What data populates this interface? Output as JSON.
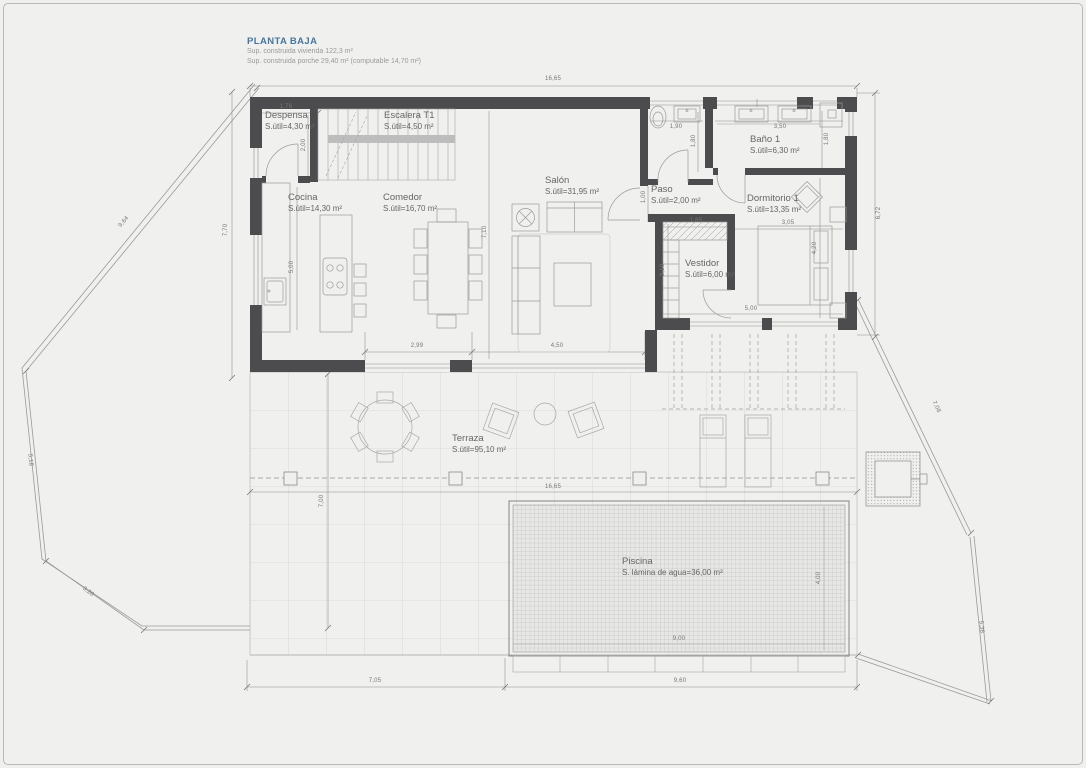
{
  "title": {
    "heading": "PLANTA BAJA",
    "line1": "Sup. construida vivienda 122,3 m²",
    "line2": "Sup. construida porche 29,40 m² (computable 14,70 m²)"
  },
  "colors": {
    "accent": "#46759e",
    "wall": "#4c4c4e",
    "line": "#9a9a9a",
    "dim_text": "#777777",
    "background": "#f0f0ee"
  },
  "rooms": {
    "despensa": {
      "name": "Despensa",
      "area": "S.útil=4,30 m²"
    },
    "escalera": {
      "name": "Escalera T1",
      "area": "S.útil=4,50 m²"
    },
    "cocina": {
      "name": "Cocina",
      "area": "S.útil=14,30 m²"
    },
    "comedor": {
      "name": "Comedor",
      "area": "S.útil=16,70 m²"
    },
    "salon": {
      "name": "Salón",
      "area": "S.útil=31,95 m²"
    },
    "paso": {
      "name": "Paso",
      "area": "S.útil=2,00 m²"
    },
    "bano1": {
      "name": "Baño 1",
      "area": "S.útil=6,30 m²"
    },
    "dormitorio1": {
      "name": "Dormitorio 1",
      "area": "S.útil=13,35 m²"
    },
    "vestidor": {
      "name": "Vestidor",
      "area": "S.útil=6,00 m²"
    },
    "terraza": {
      "name": "Terraza",
      "area": "S.útil=95,10 m²"
    },
    "piscina": {
      "name": "Piscina",
      "area": "S. lámina de agua=36,00 m²"
    }
  },
  "dims": [
    {
      "v": "16,65"
    },
    {
      "v": "16,65"
    },
    {
      "v": "7,70"
    },
    {
      "v": "9,64"
    },
    {
      "v": "5,18"
    },
    {
      "v": "3,20"
    },
    {
      "v": "6,72"
    },
    {
      "v": "7,08"
    },
    {
      "v": "5,38"
    },
    {
      "v": "7,05"
    },
    {
      "v": "9,60"
    },
    {
      "v": "7,00"
    },
    {
      "v": "9,00"
    },
    {
      "v": "4,00"
    },
    {
      "v": "1,76"
    },
    {
      "v": "2,00"
    },
    {
      "v": "5,00"
    },
    {
      "v": "7,10"
    },
    {
      "v": "2,99"
    },
    {
      "v": "4,50"
    },
    {
      "v": "1,90"
    },
    {
      "v": "1,80"
    },
    {
      "v": "3,50"
    },
    {
      "v": "1,80"
    },
    {
      "v": "1,00"
    },
    {
      "v": "1,85"
    },
    {
      "v": "3,10"
    },
    {
      "v": "5,00"
    },
    {
      "v": "3,05"
    },
    {
      "v": "4,20"
    }
  ]
}
